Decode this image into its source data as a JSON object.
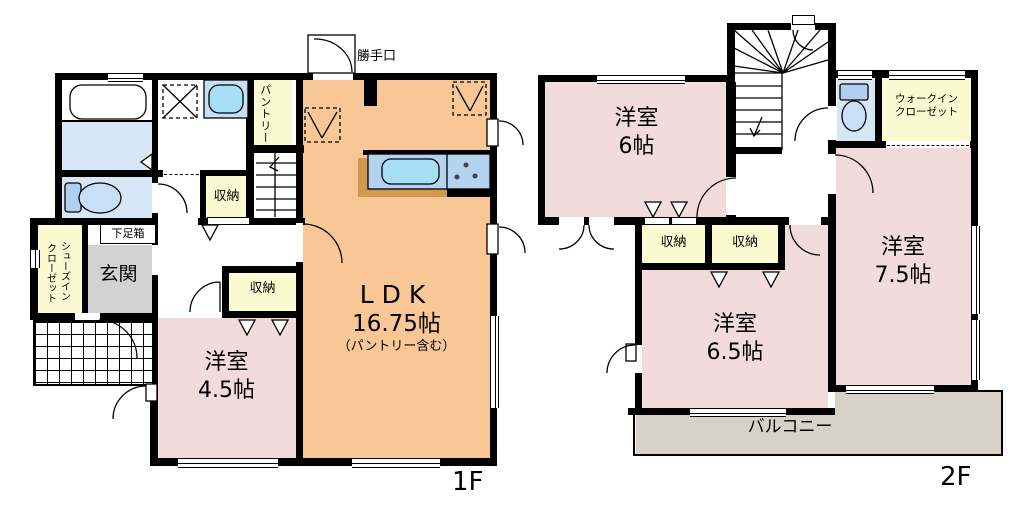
{
  "f1": {
    "floor": "1F",
    "ldk1": "LDK",
    "ldk2": "16.75帖",
    "ldk3": "（パントリー含む）",
    "y45a": "洋室",
    "y45b": "4.5帖",
    "genkan": "玄関",
    "getabako": "下足箱",
    "pantry": "パントリー",
    "sic1": "シューズイン",
    "sic2": "クローゼット",
    "shuno_hall": "収納",
    "shuno_room": "収納",
    "katteguchi": "勝手口"
  },
  "f2": {
    "floor": "2F",
    "y6a": "洋室",
    "y6b": "6帖",
    "y65a": "洋室",
    "y65b": "6.5帖",
    "y75a": "洋室",
    "y75b": "7.5帖",
    "wic1": "ウォークイン",
    "wic2": "クローゼット",
    "shuno_left": "収納",
    "shuno_right": "収納",
    "balcony": "バルコニー"
  },
  "colors": {
    "wall": "#000000",
    "room_pink": "#F1DBDB",
    "ldk_orange": "#F8C795",
    "closet_yellow": "#FAFAD0",
    "water_blue": "#D6E6F5",
    "fixture_blue": "#AFCFEE",
    "sink_cyan": "#A5DEF5",
    "genkan_gray": "#D2D2D2",
    "balcony_beige": "#D8D1C7",
    "counter_brown": "#D1994F"
  }
}
